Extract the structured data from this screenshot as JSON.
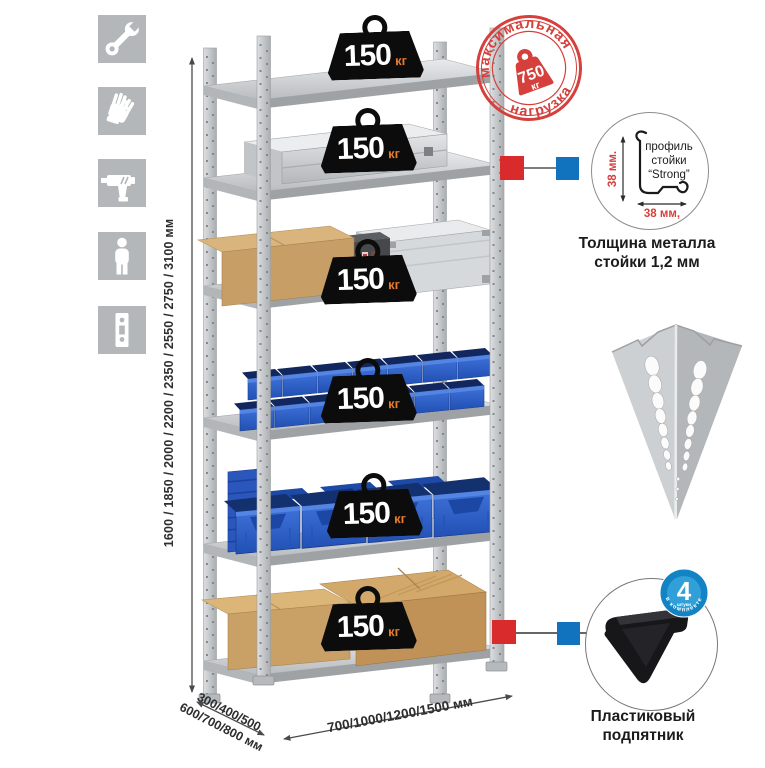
{
  "side_icons": [
    {
      "name": "wrench-icon"
    },
    {
      "name": "gloves-icon"
    },
    {
      "name": "drill-icon"
    },
    {
      "name": "person-icon"
    },
    {
      "name": "rack-post-icon"
    }
  ],
  "height_dimension": {
    "label": "1600 / 1850 / 2000 / 2200 / 2350 / 2550 / 2750 / 3100 мм"
  },
  "depth_dimension": {
    "line1": "300/400/500",
    "line2": "600/700/800 мм"
  },
  "width_dimension": {
    "label": "700/1000/1200/1500 мм"
  },
  "max_load_stamp": {
    "arc_top": "максимальная",
    "arc_bottom": "нагрузка",
    "value": "750",
    "unit": "кг"
  },
  "shelf_load_badges": [
    {
      "value": "150",
      "unit": "кг"
    },
    {
      "value": "150",
      "unit": "кг"
    },
    {
      "value": "150",
      "unit": "кг"
    },
    {
      "value": "150",
      "unit": "кг"
    },
    {
      "value": "150",
      "unit": "кг"
    },
    {
      "value": "150",
      "unit": "кг"
    }
  ],
  "profile_callout": {
    "height_dim": "38 мм.",
    "width_dim": "38 мм,",
    "label_line1": "профиль",
    "label_line2": "стойки",
    "label_line3": "“Strong”",
    "caption_line1": "Толщина металла",
    "caption_line2": "стойки 1,2 мм"
  },
  "foot_callout": {
    "badge_value": "4",
    "badge_subtext": "штуки",
    "badge_arc": "в комплекте",
    "caption_line1": "Пластиковый",
    "caption_line2": "подпятник"
  },
  "colors": {
    "stamp_red": "#d6403c",
    "callout_red": "#d92b2b",
    "callout_blue": "#1173bd",
    "badge_black": "#0c0c0c",
    "badge_unit_orange": "#e87b2e",
    "bin_blue": "#2d5fc7",
    "kit_badge_blue": "#1283c4",
    "icon_tile_gray": "#b3b7ba"
  }
}
